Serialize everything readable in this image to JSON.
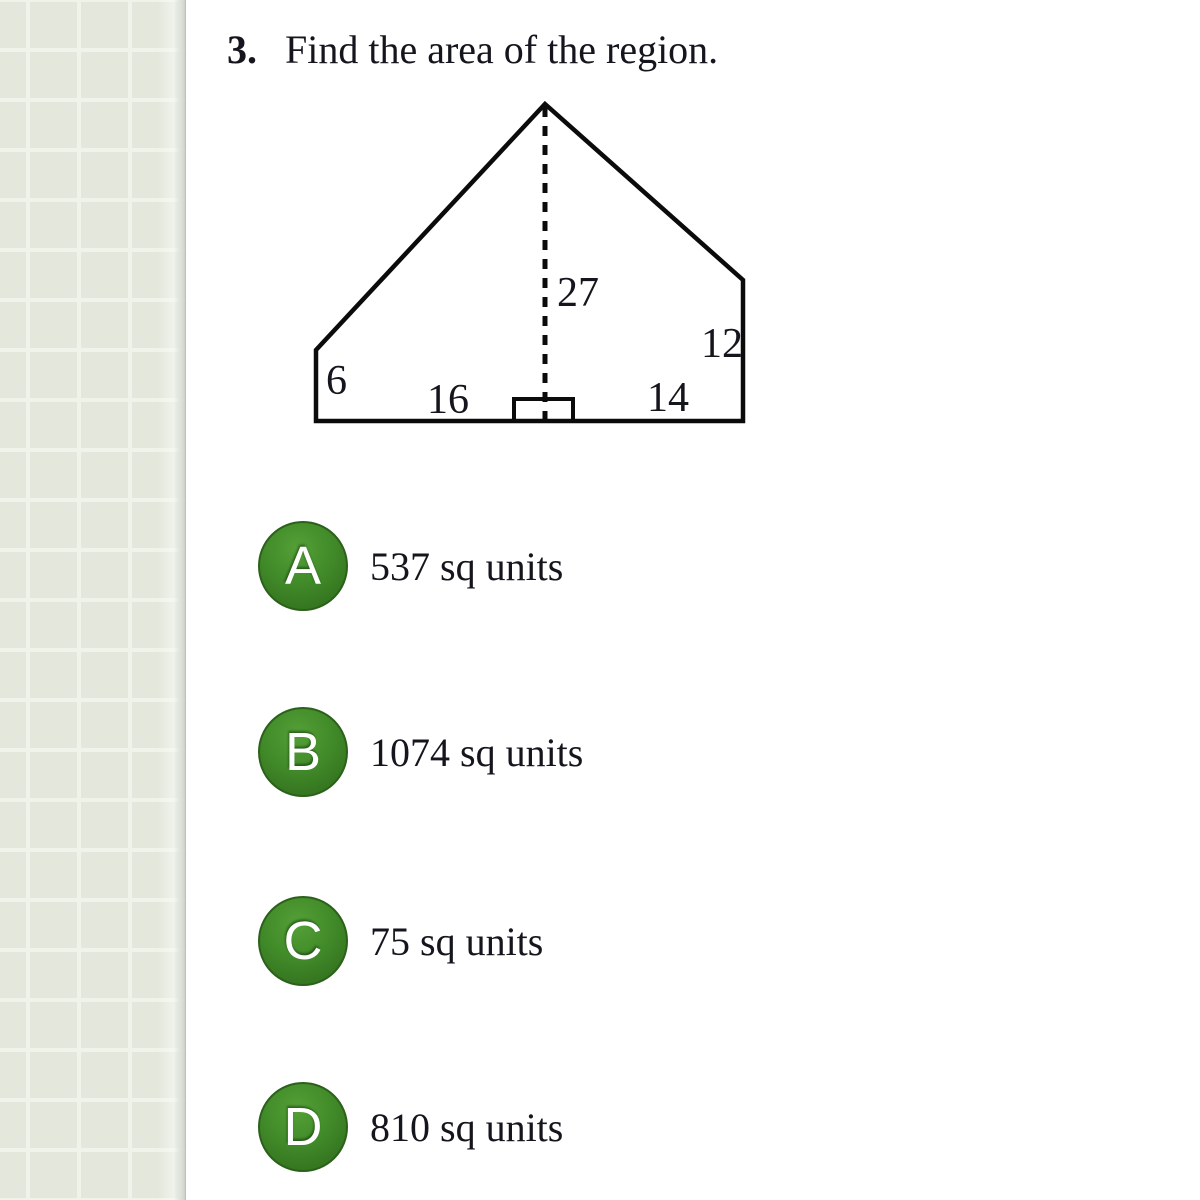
{
  "question": {
    "number": "3.",
    "text": "Find the area of the region."
  },
  "figure": {
    "description": "pentagon-region-with-dashed-altitude",
    "labels": {
      "height": "27",
      "right_side": "12",
      "left_side": "6",
      "bottom_left": "16",
      "bottom_right": "14"
    }
  },
  "options": [
    {
      "letter": "A",
      "text": "537 sq units"
    },
    {
      "letter": "B",
      "text": "1074 sq units"
    },
    {
      "letter": "C",
      "text": "75 sq units"
    },
    {
      "letter": "D",
      "text": "810 sq units"
    }
  ],
  "colors": {
    "sidebar_cell": "#e3e7dc",
    "sidebar_line": "#eff3e9",
    "option_badge_top": "#54a037",
    "option_badge_bottom": "#2d681a",
    "figure_stroke": "#0b0b0b",
    "text": "#15151d"
  }
}
